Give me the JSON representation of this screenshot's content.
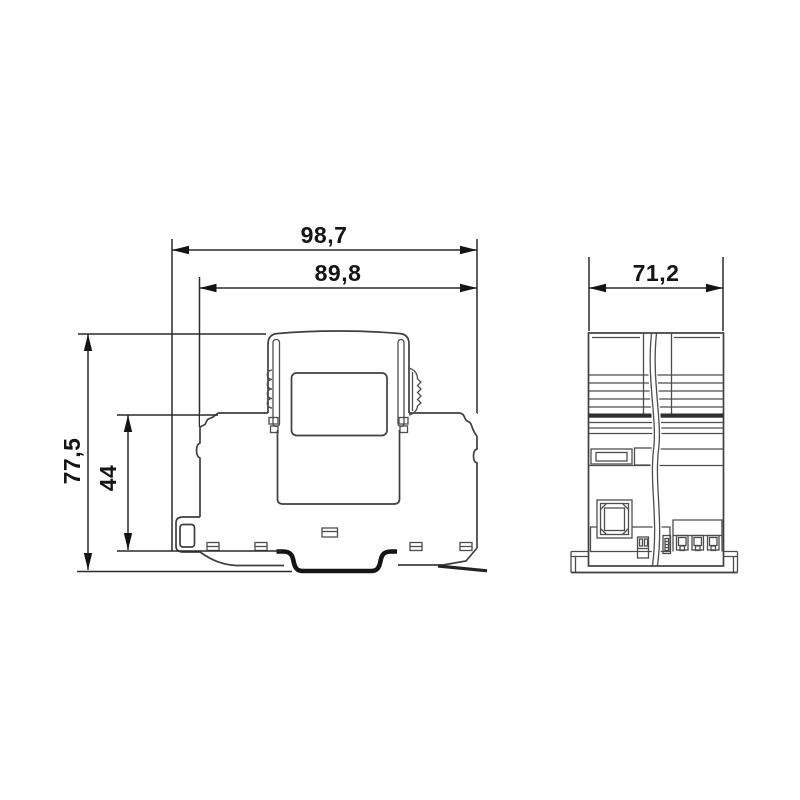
{
  "page": {
    "background": "#ffffff"
  },
  "drawing": {
    "kind": "technical-dimension-drawing",
    "dimensions": {
      "overall_width": "98,7",
      "housing_width": "89,8",
      "depth": "71,2",
      "overall_height": "77,5",
      "base_height": "44"
    },
    "colors": {
      "line": "#4d4d4d",
      "outline": "#3f3f3f",
      "dimension_line": "#2a2a2a",
      "text": "#141414",
      "rail_channel": "#141414",
      "background": "#ffffff"
    }
  }
}
